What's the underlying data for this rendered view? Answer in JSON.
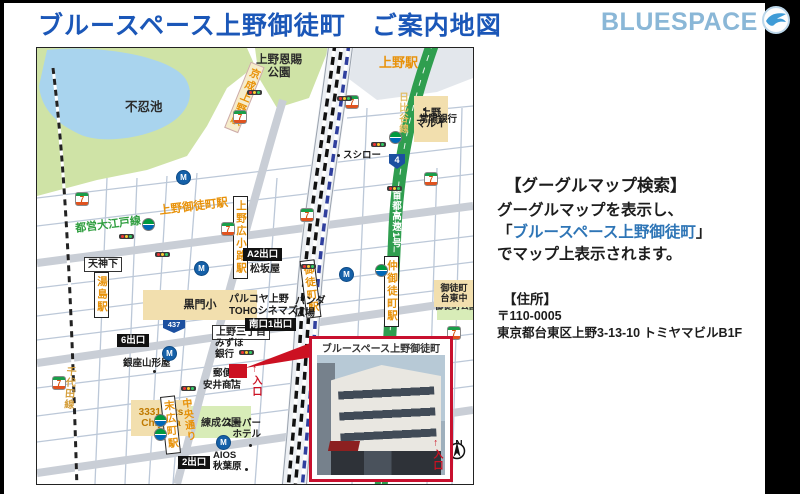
{
  "header": {
    "title": "ブルースペース上野御徒町　ご案内地図",
    "logo_text": "BLUESPACE"
  },
  "panel": {
    "search_heading": "【グーグルマップ検索】",
    "search_line1": "グーグルマップを表示し、",
    "bracket_open": "「",
    "search_highlight": "ブルースペース上野御徒町",
    "bracket_close": "」",
    "search_line3": "でマップ上表示されます。",
    "address_heading": "【住所】",
    "postal": "〒110-0005",
    "address": "東京都台東区上野3-13-10 トミヤマビルB1F"
  },
  "map": {
    "areas": {
      "pond": "不忍池",
      "ueno_park_l1": "上野恩賜",
      "ueno_park_l2": "公園",
      "rensei": "練成公園",
      "okachi_park": "御徒町公園"
    },
    "stations": {
      "ueno": "上野駅",
      "keisei_ueno": "京成上野駅",
      "ueno_okachimachi": "上野御徒町駅",
      "ueno_hirokoji": "上野広小路駅",
      "yushima": "湯島駅",
      "okachimachi": "御徒町駅",
      "naka_okachimachi": "仲御徒町駅",
      "suehirocho": "末広町駅"
    },
    "lines": {
      "oedo": "都営大江戸線",
      "chiyoda": "千代田線",
      "hibiya": "日比谷線",
      "shuto_exp": "首都高速1号",
      "chuo_dori": "中央通り"
    },
    "exits": {
      "exit6": "6出口",
      "exitA2": "A2出口",
      "south1": "南口1出口",
      "exit2_naka": "2出口",
      "exit2_sue": "2出口"
    },
    "intersections": {
      "tenjinshita": "天神下",
      "ueno3": "上野三丁目"
    },
    "buildings": {
      "marui_l1": "上野",
      "marui_l2": "マルイ",
      "kuromon": "黒門小",
      "matsuzakaya": "松坂屋",
      "arts_l1": "3331 Arts",
      "arts_l2": "Chiyoda",
      "taito_l1": "御徒町",
      "taito_l2": "台東中"
    },
    "pois": {
      "sushiro": "スシロー",
      "joyo": "常陽銀行",
      "mizuho_l1": "みずほ",
      "mizuho_l2": "銀行",
      "post": "郵便局",
      "yasui": "安井商店",
      "yamagataya": "銀座山形屋",
      "super_l1": "スーパー",
      "super_l2": "ホテル",
      "aios_l1": "AIOS",
      "aios_l2": "秋葉原",
      "parco_l1": "パルコヤ上野",
      "parco_l2": "TOHOシネマズ",
      "panda_l1": "パンダ",
      "panda_l2": "広場"
    },
    "route_shields": {
      "r4": "4",
      "r437": "437"
    },
    "entrance": "←入口",
    "inset": {
      "title": "ブルースペース上野御徒町",
      "entrance": "←入口"
    },
    "compass_n": "N",
    "icons": {
      "seven": "7",
      "metro": "M"
    }
  }
}
